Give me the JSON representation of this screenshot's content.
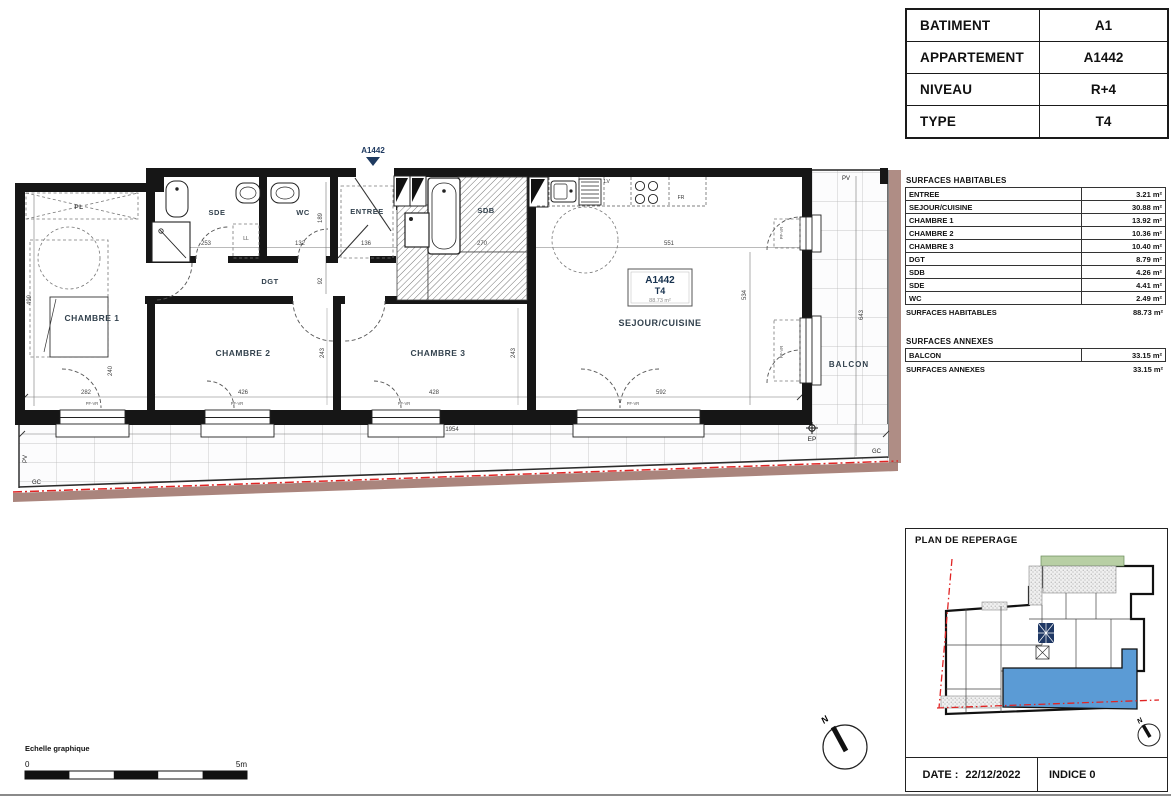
{
  "header_table": {
    "rows": [
      {
        "label": "BATIMENT",
        "value": "A1"
      },
      {
        "label": "APPARTEMENT",
        "value": "A1442"
      },
      {
        "label": "NIVEAU",
        "value": "R+4"
      },
      {
        "label": "TYPE",
        "value": "T4"
      }
    ]
  },
  "surfaces": {
    "habitables_title": "SURFACES HABITABLES",
    "habitables": [
      {
        "label": "ENTREE",
        "value": "3.21 m²"
      },
      {
        "label": "SEJOUR/CUISINE",
        "value": "30.88 m²"
      },
      {
        "label": "CHAMBRE 1",
        "value": "13.92 m²"
      },
      {
        "label": "CHAMBRE 2",
        "value": "10.36 m²"
      },
      {
        "label": "CHAMBRE 3",
        "value": "10.40 m²"
      },
      {
        "label": "DGT",
        "value": "8.79 m²"
      },
      {
        "label": "SDB",
        "value": "4.26 m²"
      },
      {
        "label": "SDE",
        "value": "4.41 m²"
      },
      {
        "label": "WC",
        "value": "2.49 m²"
      }
    ],
    "habitables_total_label": "SURFACES HABITABLES",
    "habitables_total_value": "88.73 m²",
    "annexes_title": "SURFACES ANNEXES",
    "annexes": [
      {
        "label": "BALCON",
        "value": "33.15 m²"
      }
    ],
    "annexes_total_label": "SURFACES ANNEXES",
    "annexes_total_value": "33.15 m²"
  },
  "reperage": {
    "title": "PLAN DE REPERAGE",
    "date_label": "DATE :",
    "date_value": "22/12/2022",
    "indice": "INDICE 0"
  },
  "plan": {
    "marker": "A1442",
    "north": "N",
    "unit_box": {
      "id": "A1442",
      "type": "T4",
      "area": "88.73 m²"
    },
    "rooms": {
      "chambre1": "CHAMBRE 1",
      "chambre2": "CHAMBRE 2",
      "chambre3": "CHAMBRE 3",
      "sejour": "SEJOUR/CUISINE",
      "entree": "ENTREE",
      "sde": "SDE",
      "wc": "WC",
      "sdb": "SDB",
      "dgt": "DGT",
      "balcon": "BALCON",
      "pl": "PL"
    },
    "fixtures": {
      "ll": "LL",
      "lv": "LV",
      "fr": "FR"
    },
    "marks": {
      "pv": "PV",
      "gc": "GC",
      "ep": "EP",
      "pfvr": "PF-VR"
    },
    "dims": {
      "c1_h": "499",
      "c1_w": "282",
      "sde": "253",
      "wc_w": "132",
      "ent": "136",
      "wc_h": "189",
      "dgt": "92",
      "c2_hl": "240",
      "c2_hr": "243",
      "c3_h": "243",
      "c2_w": "426",
      "c3_w": "428",
      "sej_w": "592",
      "sej_top": "551",
      "sej_h": "534",
      "sdb": "270",
      "balc": "643",
      "total": "1954"
    },
    "scalebar": {
      "title": "Echelle graphique",
      "start": "0",
      "end": "5m"
    }
  },
  "colors": {
    "highlight_blue": "#5b9bd5",
    "property_red": "#e02424",
    "band_brown": "#9b7066",
    "stair_navy": "#1f3864",
    "room_label": "#33424e"
  }
}
